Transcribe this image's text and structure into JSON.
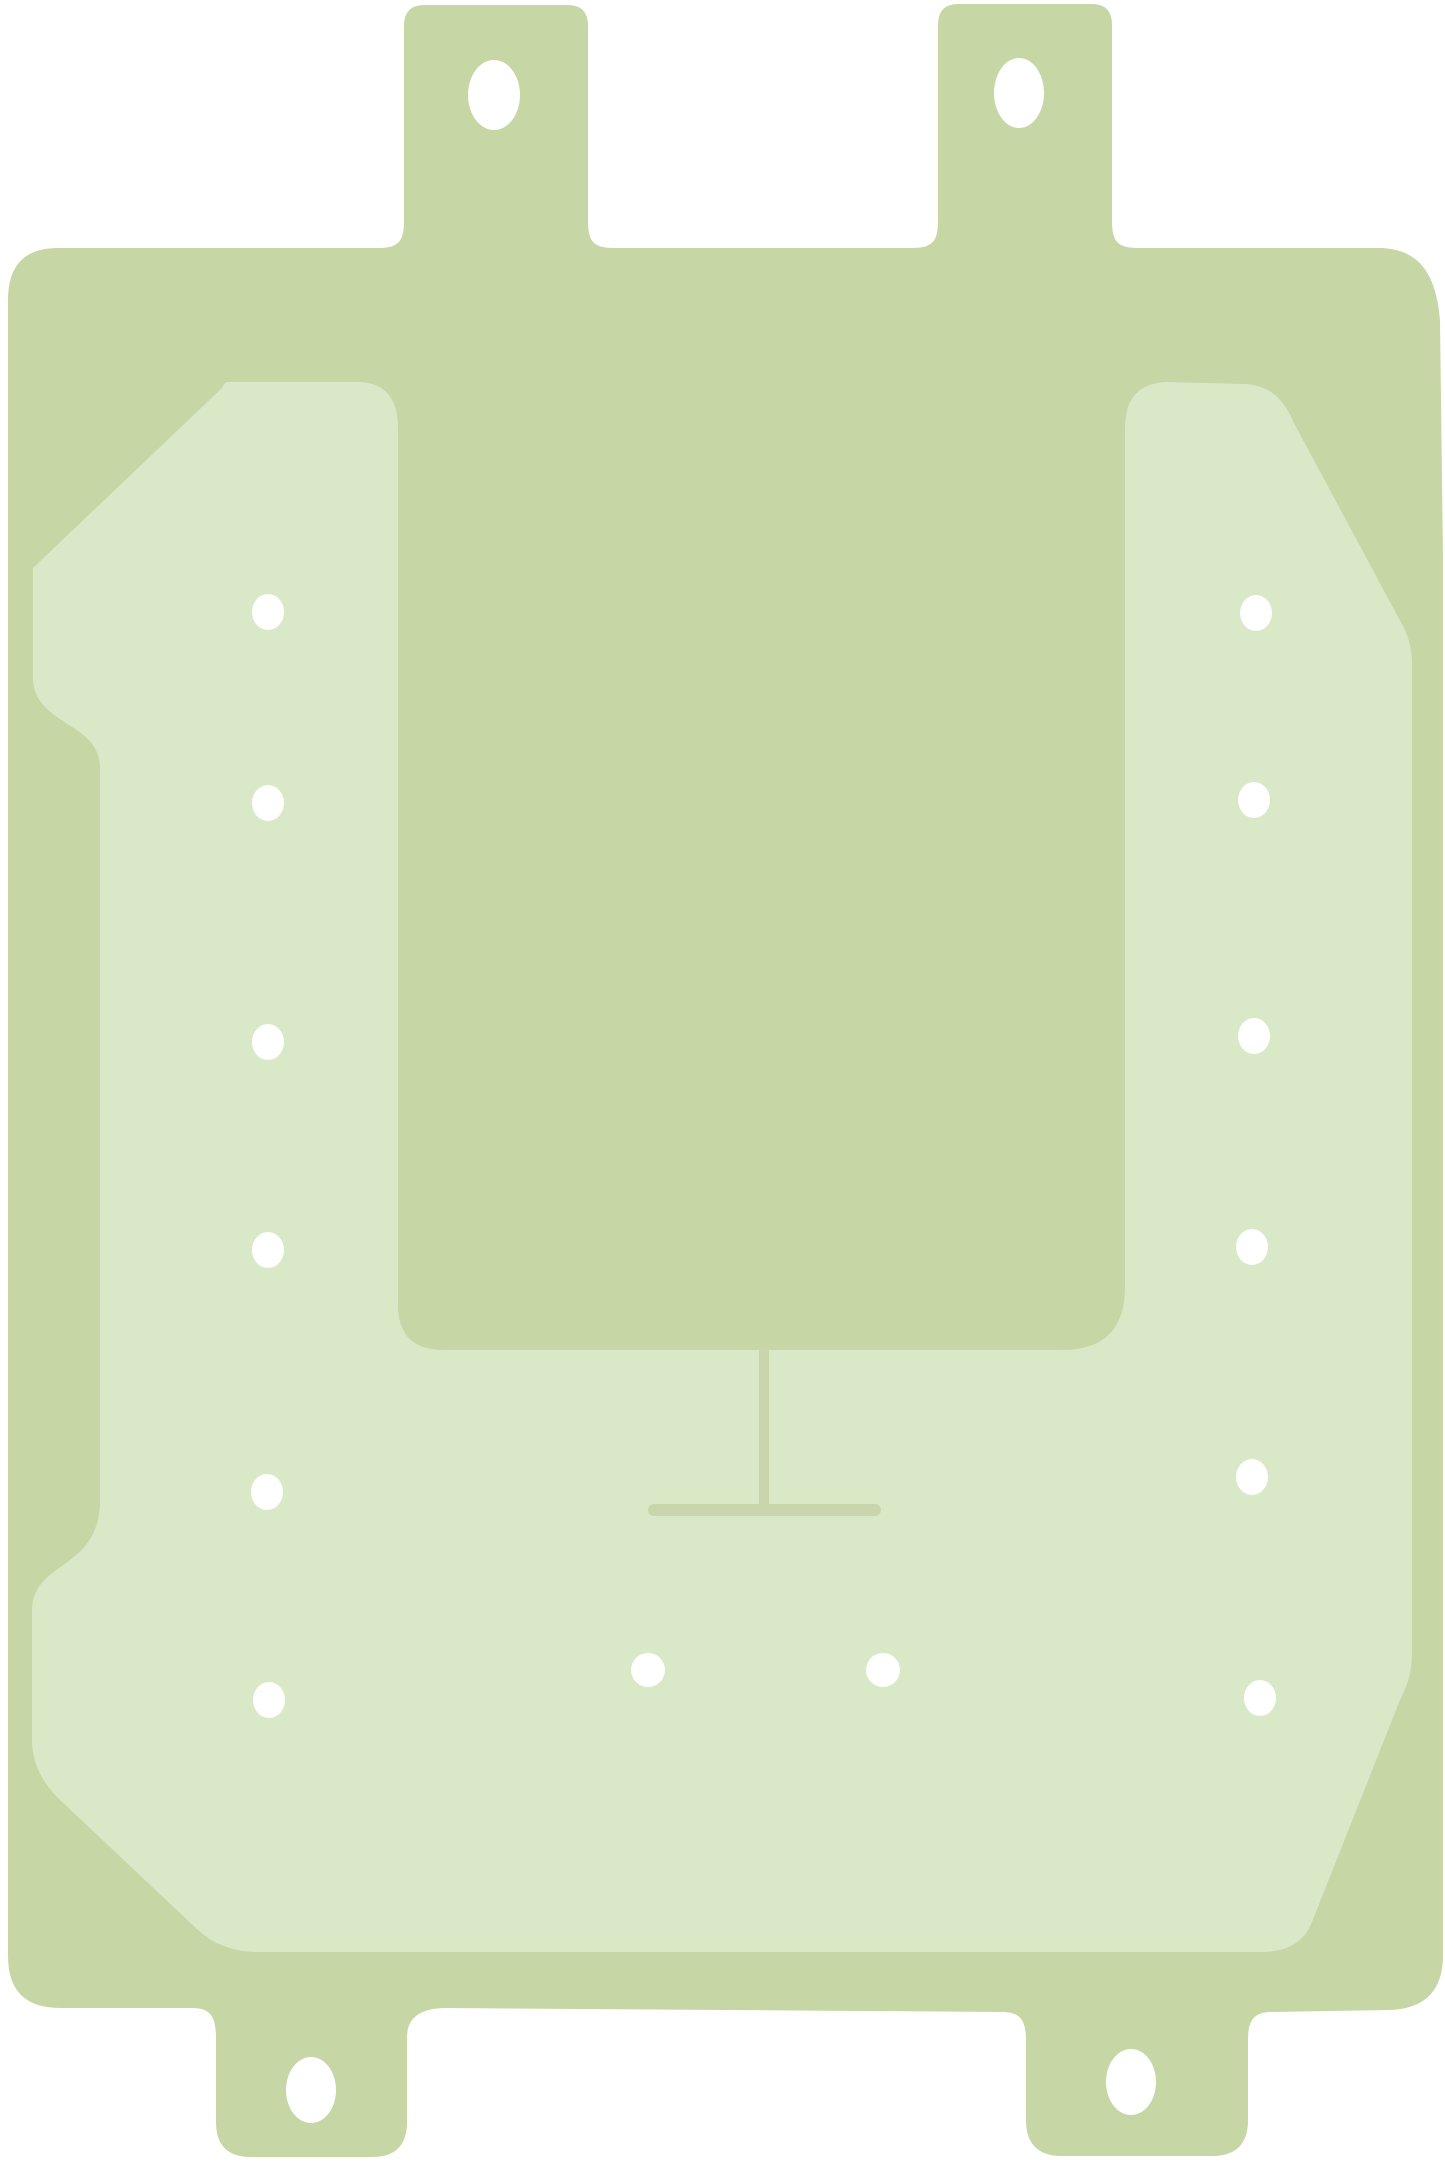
{
  "figure": {
    "description": "die-cut adhesive sheet on white background",
    "canvas": {
      "width": 1445,
      "height": 2161,
      "background": "#ffffff"
    },
    "colors": {
      "sheet_outer": "#c6d6a5",
      "liner_inner": "#d9e9c7",
      "score_line": "#c9d5aa",
      "hole": "#ffffff"
    },
    "sheet_outline_path": "M 8 300 Q 8 248 58 248 L 378 248 C 400 248 404 240 404 220 L 404 26 Q 404 5 424 5 L 568 5 Q 588 5 588 26 L 588 220 C 588 240 592 248 614 248 L 912 248 C 934 248 938 240 938 220 L 938 25 Q 938 4 958 4 L 1092 4 Q 1112 4 1112 25 L 1112 220 C 1112 240 1116 248 1138 248 L 1382 248 C 1418 250 1436 272 1440 320 L 1443 560 L 1443 1955 Q 1443 2008 1390 2010 L 1272 2012 C 1254 2012 1248 2020 1248 2040 L 1248 2120 Q 1248 2156 1212 2156 L 1062 2156 Q 1026 2156 1026 2120 L 1026 2040 C 1026 2020 1020 2012 1002 2012 L 447 2008 C 429 2008 407 2012 407 2038 L 407 2122 Q 407 2157 372 2157 L 251 2157 Q 216 2157 216 2122 L 216 2038 C 216 2016 210 2008 192 2008 L 60 2008 Q 8 2008 8 1956 Z",
    "liner_outline_path": "M 228 382 L 360 382 Q 398 384 398 428 L 398 1305 Q 398 1350 444 1350 L 1062 1350 Q 1125 1350 1125 1287 L 1125 428 Q 1125 384 1166 382 L 1246 384 C 1274 386 1286 404 1295 425 L 1404 628 Q 1412 644 1412 664 L 1412 1650 C 1412 1672 1408 1684 1400 1700 L 1312 1922 Q 1300 1952 1262 1952 L 258 1952 Q 222 1952 198 1930 L 60 1800 Q 32 1773 32 1740 L 32 1612 C 32 1560 96 1572 100 1505 L 100 768 C 100 722 36 726 33 680 L 33 568 L 222 388 Q 225 382 228 382 Z",
    "score_line": {
      "vertical": {
        "x": 764,
        "y1": 1350,
        "y2": 1505,
        "width": 10
      },
      "crossbar": {
        "y": 1510,
        "x1": 654,
        "x2": 875,
        "width": 12
      }
    },
    "holes": {
      "tab_holes": [
        {
          "cx": 494,
          "cy": 95,
          "rx": 26,
          "ry": 35
        },
        {
          "cx": 1019,
          "cy": 93,
          "rx": 25,
          "ry": 35
        },
        {
          "cx": 311,
          "cy": 2090,
          "rx": 25,
          "ry": 33
        },
        {
          "cx": 1131,
          "cy": 2082,
          "rx": 25,
          "ry": 33
        }
      ],
      "left_column": [
        {
          "cx": 268,
          "cy": 612,
          "rx": 16,
          "ry": 18
        },
        {
          "cx": 268,
          "cy": 803,
          "rx": 16,
          "ry": 18
        },
        {
          "cx": 268,
          "cy": 1042,
          "rx": 16,
          "ry": 18
        },
        {
          "cx": 268,
          "cy": 1250,
          "rx": 16,
          "ry": 18
        },
        {
          "cx": 267,
          "cy": 1492,
          "rx": 16,
          "ry": 18
        },
        {
          "cx": 269,
          "cy": 1700,
          "rx": 16,
          "ry": 18
        }
      ],
      "right_column": [
        {
          "cx": 1256,
          "cy": 613,
          "rx": 16,
          "ry": 18
        },
        {
          "cx": 1254,
          "cy": 800,
          "rx": 16,
          "ry": 18
        },
        {
          "cx": 1254,
          "cy": 1036,
          "rx": 16,
          "ry": 18
        },
        {
          "cx": 1252,
          "cy": 1247,
          "rx": 16,
          "ry": 18
        },
        {
          "cx": 1252,
          "cy": 1477,
          "rx": 16,
          "ry": 18
        },
        {
          "cx": 1260,
          "cy": 1698,
          "rx": 16,
          "ry": 18
        }
      ],
      "bottom_pair": [
        {
          "cx": 648,
          "cy": 1670,
          "rx": 17,
          "ry": 17
        },
        {
          "cx": 883,
          "cy": 1670,
          "rx": 17,
          "ry": 17
        }
      ]
    }
  }
}
